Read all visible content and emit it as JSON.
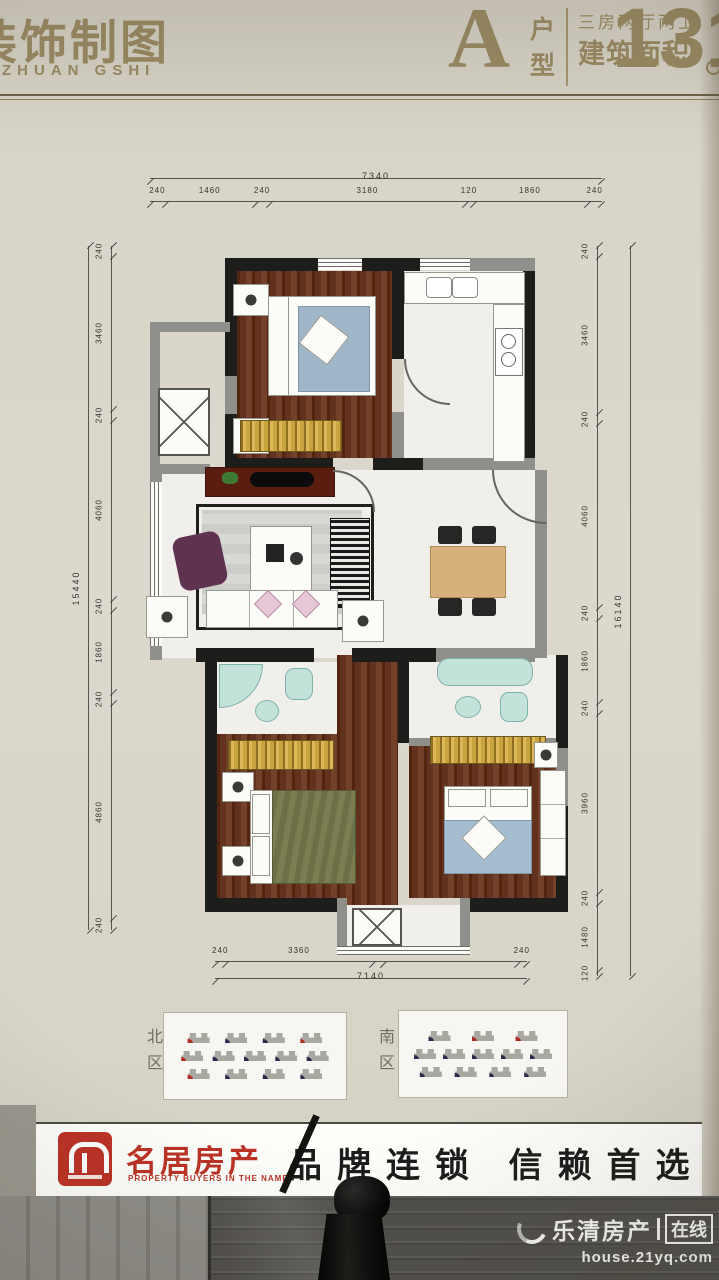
{
  "header": {
    "studio_title": "装饰制图",
    "studio_subtitle": "ZHUAN GSHI",
    "unit_letter": "A",
    "unit_type_label": "户型",
    "layout_spec": "三房两厅两卫",
    "area_label": "建筑面积",
    "area_value": "131"
  },
  "floorplan": {
    "dim_top": {
      "overall": "7340",
      "segments": [
        "240",
        "1460",
        "240",
        "3180",
        "120",
        "1860",
        "240"
      ]
    },
    "dim_bottom": {
      "overall": "7140",
      "segments": [
        "240",
        "3360",
        "240",
        "3060",
        "240"
      ]
    },
    "dim_left": {
      "overall": "15440",
      "segments": [
        "240",
        "3460",
        "240",
        "4060",
        "240",
        "1860",
        "240",
        "4860",
        "240"
      ]
    },
    "dim_right": {
      "overall": "16140",
      "segments": [
        "240",
        "3460",
        "240",
        "4060",
        "240",
        "1860",
        "240",
        "3960",
        "240",
        "1480",
        "120"
      ]
    }
  },
  "site_plans": {
    "north": {
      "label": "北区",
      "rows": [
        [
          "r",
          "n",
          "n",
          "r"
        ],
        [
          "r",
          "n",
          "n",
          "n",
          "n"
        ],
        [
          "r",
          "n",
          "n",
          "n"
        ]
      ]
    },
    "south": {
      "label": "南区",
      "rows": [
        [
          "n",
          "r",
          "r"
        ],
        [
          "n",
          "n",
          "n",
          "n",
          "n"
        ],
        [
          "n",
          "n",
          "n",
          "n"
        ]
      ]
    }
  },
  "brand_bar": {
    "company_name": "名居房产",
    "company_tagline": "PROPERTY BUYERS IN THE NAME",
    "slogan": "品牌连锁 信赖首选"
  },
  "watermark": {
    "site_name": "乐清房产",
    "site_badge": "在线",
    "site_url": "house.21yq.com"
  },
  "colors": {
    "gold_text": "#9a8a63",
    "brand_red": "#bb3226",
    "slogan_black": "#1c1c1c",
    "wood_floor": "#63321f",
    "wardrobe_gold": "#c9a53f",
    "bath_teal": "#c3e2da",
    "badge_red": "#b22b24",
    "badge_navy": "#2b2b4e",
    "dim_line": "#55544f"
  }
}
